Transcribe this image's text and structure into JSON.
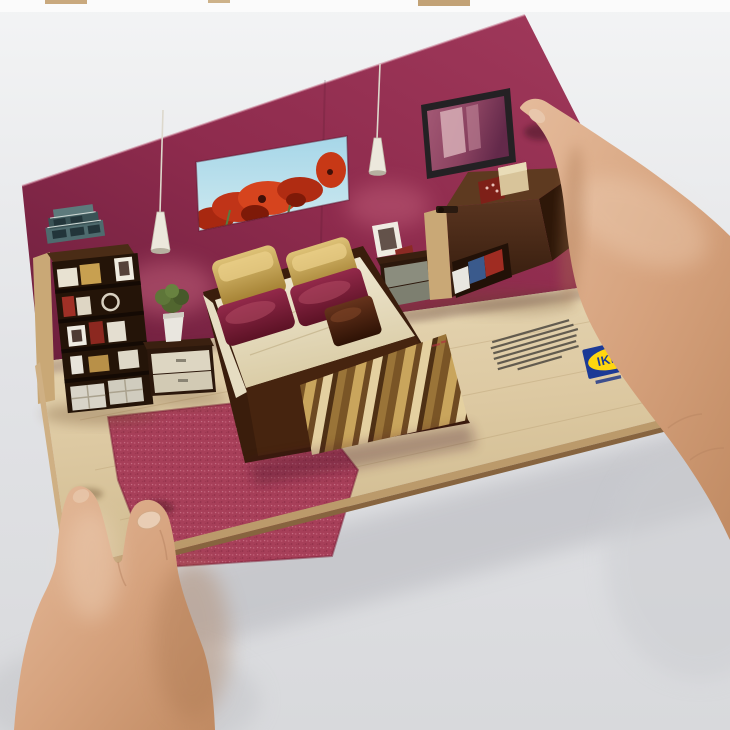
{
  "image": {
    "type": "photograph",
    "subject": "Two hands holding an IKEA 3D pop-up mailer showing a miniature paper bedroom",
    "background": "plain light-gray studio backdrop"
  },
  "brand": {
    "logo_text": "IKEA",
    "logo_blue": "#1c3a96",
    "logo_yellow": "#ffd60f",
    "tagline_present": true
  },
  "fine_print": {
    "present": true,
    "legible": false,
    "approx_lines": 7
  },
  "room": {
    "wall_color": "#8e2b4d",
    "floor_color": "#ddc9a2",
    "rug_color": "#a23a54",
    "objects": [
      "poppy painting",
      "wall mirror",
      "pendant lamp left",
      "pendant lamp right",
      "bookshelf with books and baskets",
      "storage boxes on bookshelf",
      "nightstand with potted plant",
      "double bed with gold and maroon pillows",
      "striped blanket",
      "second nightstand with photo frame",
      "dresser with open drawer of clothes",
      "raspberry rug"
    ]
  },
  "hands": {
    "left": "holds bottom-left corner of the card",
    "right": "holds right edge of the card"
  }
}
